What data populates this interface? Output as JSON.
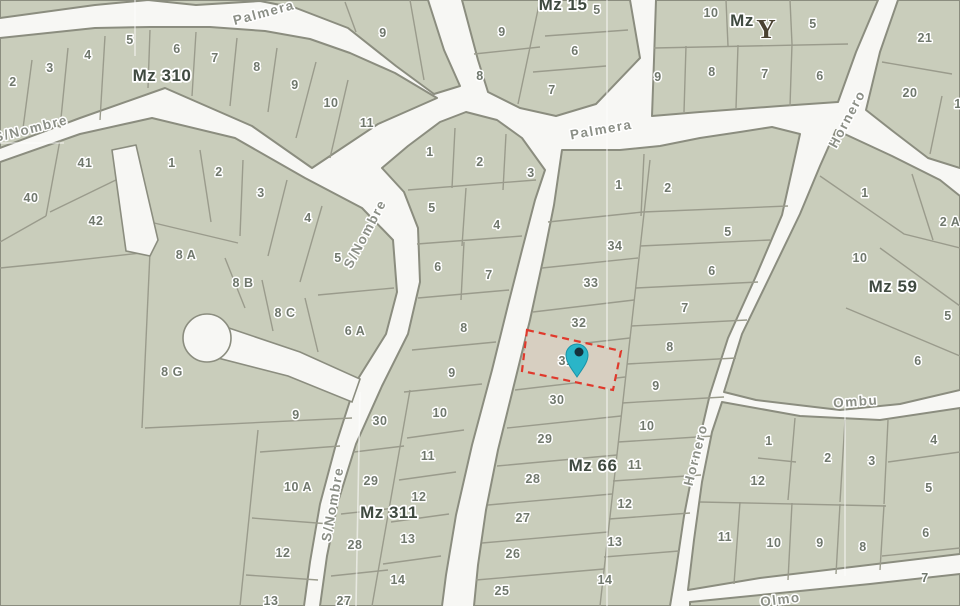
{
  "map": {
    "colors": {
      "street": "#f7f7f4",
      "parcel_fill": "#c9cdbb",
      "block_stroke": "#8b8d7f",
      "lot_line": "#9a9b8c",
      "faint_line": "rgba(255,255,255,0.55)",
      "parcel_label": "#6f776c",
      "block_label": "#3f4a40",
      "street_label": "#8b8f86",
      "highlight_fill": "#d7cfc1",
      "highlight_stroke": "#e0392c",
      "pin_fill": "#2ab5c8",
      "pin_stroke": "#1894a9",
      "pin_dot": "#15323d",
      "tree_icon": "#4a4232"
    },
    "street_labels": [
      {
        "text": "Palmera",
        "x": 265,
        "y": 17,
        "rot": -15
      },
      {
        "text": "Palmera",
        "x": 602,
        "y": 134,
        "rot": -10
      },
      {
        "text": "S/Nombre",
        "x": 32,
        "y": 133,
        "rot": -14
      },
      {
        "text": "S/Nombre",
        "x": 369,
        "y": 236,
        "rot": -62
      },
      {
        "text": "S/Nombre",
        "x": 337,
        "y": 505,
        "rot": -80
      },
      {
        "text": "Hornero",
        "x": 851,
        "y": 121,
        "rot": -62
      },
      {
        "text": "Hornero",
        "x": 700,
        "y": 456,
        "rot": -76
      },
      {
        "text": "Ombu",
        "x": 856,
        "y": 406,
        "rot": -4
      },
      {
        "text": "Olmo",
        "x": 781,
        "y": 604,
        "rot": -7
      }
    ],
    "blocks": [
      {
        "name": "mz310-band",
        "outline": "0,38 95,28 150,27 210,27 265,31 310,39 350,53 395,73 437,98 378,124 312,168 252,126 165,88 80,118 0,148",
        "label": {
          "text": "Mz 310",
          "x": 162,
          "y": 81
        },
        "parcels": [
          {
            "t": "2",
            "x": 13,
            "y": 86
          },
          {
            "t": "3",
            "x": 50,
            "y": 72
          },
          {
            "t": "4",
            "x": 88,
            "y": 59
          },
          {
            "t": "5",
            "x": 130,
            "y": 44
          },
          {
            "t": "6",
            "x": 177,
            "y": 53
          },
          {
            "t": "7",
            "x": 215,
            "y": 62
          },
          {
            "t": "8",
            "x": 257,
            "y": 71
          },
          {
            "t": "9",
            "x": 295,
            "y": 89
          },
          {
            "t": "10",
            "x": 331,
            "y": 107
          },
          {
            "t": "11",
            "x": 367,
            "y": 127
          }
        ],
        "lot_lines": [
          "32,60 22,136",
          "68,48 60,128",
          "105,36 100,120",
          "150,30 148,88",
          "196,32 192,96",
          "237,38 230,106",
          "277,48 268,112",
          "316,62 296,138",
          "348,80 330,158"
        ]
      },
      {
        "name": "corner-strip",
        "outline": "0,0 428,0 444,50 460,86 434,94 396,66 348,28 296,8 260,1 196,5 148,0 95,5 0,18",
        "parcels": [
          {
            "t": "9",
            "x": 383,
            "y": 37
          }
        ],
        "lot_lines": [
          "345,2 356,32",
          "410,0 424,80"
        ]
      },
      {
        "name": "mz15-block",
        "outline": "462,0 630,0 640,58 596,104 556,116 520,108 488,92 478,60",
        "label": {
          "text": "Mz 15",
          "x": 563,
          "y": 10
        },
        "parcels": [
          {
            "t": "9",
            "x": 502,
            "y": 36
          },
          {
            "t": "8",
            "x": 480,
            "y": 80
          },
          {
            "t": "5",
            "x": 597,
            "y": 14
          },
          {
            "t": "6",
            "x": 575,
            "y": 55
          },
          {
            "t": "7",
            "x": 552,
            "y": 94
          }
        ],
        "lot_lines": [
          "540,0 518,104",
          "545,36 628,30",
          "533,72 606,66",
          "474,54 540,47"
        ]
      },
      {
        "name": "mz-tree-block",
        "outline": "656,0 878,0 856,52 838,102 780,106 700,112 652,116 654,60",
        "label": {
          "text": "Mz",
          "x": 742,
          "y": 26
        },
        "parcels": [
          {
            "t": "10",
            "x": 711,
            "y": 17
          },
          {
            "t": "5",
            "x": 813,
            "y": 28
          },
          {
            "t": "9",
            "x": 658,
            "y": 81
          },
          {
            "t": "8",
            "x": 712,
            "y": 76
          },
          {
            "t": "7",
            "x": 765,
            "y": 78
          },
          {
            "t": "6",
            "x": 820,
            "y": 80
          }
        ],
        "lot_lines": [
          "654,48 848,44",
          "726,0 728,46",
          "790,0 792,44",
          "686,46 684,112",
          "738,45 736,108",
          "792,44 790,106"
        ]
      },
      {
        "name": "ne-block",
        "outline": "898,0 960,0 960,168 928,158 894,132 866,110 880,52",
        "parcels": [
          {
            "t": "21",
            "x": 925,
            "y": 42
          },
          {
            "t": "20",
            "x": 910,
            "y": 97
          },
          {
            "t": "1",
            "x": 958,
            "y": 108
          }
        ],
        "lot_lines": [
          "882,62 952,74",
          "942,96 930,154"
        ]
      },
      {
        "name": "mz59-block",
        "outline": "836,130 892,156 940,180 960,196 960,390 900,404 840,410 756,400 724,392 742,334 772,272 800,214 820,166",
        "label": {
          "text": "Mz 59",
          "x": 893,
          "y": 292
        },
        "parcels": [
          {
            "t": "1",
            "x": 865,
            "y": 197
          },
          {
            "t": "2 A",
            "x": 950,
            "y": 226
          },
          {
            "t": "10",
            "x": 860,
            "y": 262
          },
          {
            "t": "5",
            "x": 948,
            "y": 320
          },
          {
            "t": "6",
            "x": 918,
            "y": 365
          }
        ],
        "lot_lines": [
          "820,176 904,234 960,248",
          "912,174 933,240",
          "880,248 960,306",
          "846,308 960,356"
        ]
      },
      {
        "name": "mz66-block",
        "outline": "562,150 620,150 660,146 700,138 740,132 772,127 800,134 782,215 756,276 728,338 710,394 696,454 684,516 676,570 670,606 474,606 478,565 486,510 498,450 514,385 530,320 543,260 554,205",
        "label": {
          "text": "Mz 66",
          "x": 593,
          "y": 471
        },
        "parcels": [
          {
            "t": "1",
            "x": 619,
            "y": 189
          },
          {
            "t": "2",
            "x": 668,
            "y": 192
          },
          {
            "t": "34",
            "x": 615,
            "y": 250
          },
          {
            "t": "33",
            "x": 591,
            "y": 287
          },
          {
            "t": "32",
            "x": 579,
            "y": 327
          },
          {
            "t": "31",
            "x": 566,
            "y": 365
          },
          {
            "t": "30",
            "x": 557,
            "y": 404
          },
          {
            "t": "29",
            "x": 545,
            "y": 443
          },
          {
            "t": "28",
            "x": 533,
            "y": 483
          },
          {
            "t": "27",
            "x": 523,
            "y": 522
          },
          {
            "t": "26",
            "x": 513,
            "y": 558
          },
          {
            "t": "25",
            "x": 502,
            "y": 595
          },
          {
            "t": "5",
            "x": 728,
            "y": 236
          },
          {
            "t": "6",
            "x": 712,
            "y": 275
          },
          {
            "t": "7",
            "x": 685,
            "y": 312
          },
          {
            "t": "8",
            "x": 670,
            "y": 351
          },
          {
            "t": "9",
            "x": 656,
            "y": 390
          },
          {
            "t": "10",
            "x": 647,
            "y": 430
          },
          {
            "t": "11",
            "x": 635,
            "y": 469
          },
          {
            "t": "12",
            "x": 625,
            "y": 508
          },
          {
            "t": "13",
            "x": 615,
            "y": 546
          },
          {
            "t": "14",
            "x": 605,
            "y": 584
          }
        ],
        "lot_lines": [
          "650,160 600,606",
          "644,154 641,216",
          "548,222 643,212",
          "643,212 788,206",
          "542,268 638,258",
          "533,312 634,300",
          "524,350 630,338",
          "515,390 625,377",
          "507,428 621,416",
          "497,466 617,455",
          "488,505 612,494",
          "482,543 608,532",
          "476,580 604,569",
          "640,246 770,240",
          "636,288 758,282",
          "631,326 747,320",
          "627,364 736,358",
          "622,403 724,397",
          "618,442 713,436",
          "613,481 701,475",
          "609,519 690,513",
          "604,557 679,551"
        ]
      },
      {
        "name": "mz311-block",
        "outline": "404,192 382,168 408,146 440,122 466,112 497,120 522,138 545,170 535,200 522,250 508,305 492,370 472,445 456,515 446,575 442,606 320,606 327,556 338,502 356,444 382,386 408,334 420,282 418,228",
        "label": {
          "text": "Mz 311",
          "x": 389,
          "y": 518
        },
        "parcels": [
          {
            "t": "1",
            "x": 430,
            "y": 156
          },
          {
            "t": "2",
            "x": 480,
            "y": 166
          },
          {
            "t": "3",
            "x": 531,
            "y": 177
          },
          {
            "t": "5",
            "x": 432,
            "y": 212
          },
          {
            "t": "4",
            "x": 497,
            "y": 229
          },
          {
            "t": "6",
            "x": 438,
            "y": 271
          },
          {
            "t": "7",
            "x": 489,
            "y": 279
          },
          {
            "t": "8",
            "x": 464,
            "y": 332
          },
          {
            "t": "9",
            "x": 452,
            "y": 377
          },
          {
            "t": "10",
            "x": 440,
            "y": 417
          },
          {
            "t": "11",
            "x": 428,
            "y": 460
          },
          {
            "t": "12",
            "x": 419,
            "y": 501
          },
          {
            "t": "13",
            "x": 408,
            "y": 543
          },
          {
            "t": "14",
            "x": 398,
            "y": 584
          },
          {
            "t": "30",
            "x": 380,
            "y": 425
          },
          {
            "t": "29",
            "x": 371,
            "y": 485
          },
          {
            "t": "28",
            "x": 355,
            "y": 549
          },
          {
            "t": "27",
            "x": 344,
            "y": 605
          }
        ],
        "lot_lines": [
          "455,128 452,188",
          "506,134 503,190",
          "408,190 536,180",
          "466,188 462,246",
          "417,244 522,236",
          "464,242 461,300",
          "418,298 509,290",
          "412,350 496,342",
          "404,392 482,384",
          "410,390 372,606",
          "407,438 464,430",
          "399,480 456,472",
          "391,522 449,514",
          "383,564 441,556",
          "354,452 404,446",
          "341,514 396,508",
          "331,576 388,570"
        ]
      },
      {
        "name": "sw-superblock",
        "outline": "0,162 80,134 152,118 235,138 305,178 362,208 393,240 397,292 386,334 356,382 336,444 320,504 310,562 304,606 0,606",
        "parcels": [
          {
            "t": "41",
            "x": 85,
            "y": 167
          },
          {
            "t": "40",
            "x": 31,
            "y": 202
          },
          {
            "t": "42",
            "x": 96,
            "y": 225
          },
          {
            "t": "1",
            "x": 172,
            "y": 167
          },
          {
            "t": "2",
            "x": 219,
            "y": 176
          },
          {
            "t": "3",
            "x": 261,
            "y": 197
          },
          {
            "t": "4",
            "x": 308,
            "y": 222
          },
          {
            "t": "5",
            "x": 338,
            "y": 262
          },
          {
            "t": "8 A",
            "x": 186,
            "y": 259
          },
          {
            "t": "8 B",
            "x": 243,
            "y": 287
          },
          {
            "t": "8 C",
            "x": 285,
            "y": 317
          },
          {
            "t": "6 A",
            "x": 355,
            "y": 335
          },
          {
            "t": "8 G",
            "x": 172,
            "y": 376
          },
          {
            "t": "9",
            "x": 296,
            "y": 419
          },
          {
            "t": "10 A",
            "x": 298,
            "y": 491
          },
          {
            "t": "12",
            "x": 283,
            "y": 557
          },
          {
            "t": "13",
            "x": 271,
            "y": 605
          }
        ],
        "lot_lines": [
          "60,140 46,216",
          "120,178 50,212",
          "46,216 0,242",
          "150,252 60,262 0,268",
          "150,252 142,428",
          "200,150 211,222",
          "243,160 240,236",
          "287,180 268,256",
          "322,206 300,282",
          "150,222 238,243",
          "225,258 245,308",
          "262,280 273,331",
          "305,298 318,352",
          "318,295 394,288",
          "145,428 352,418",
          "258,430 240,606",
          "260,452 340,446",
          "252,518 330,524",
          "246,575 318,580"
        ]
      },
      {
        "name": "se-block",
        "outline": "722,402 800,416 880,420 960,408 960,554 860,566 760,578 688,590 694,540 702,482 712,432",
        "parcels": [
          {
            "t": "1",
            "x": 769,
            "y": 445
          },
          {
            "t": "2",
            "x": 828,
            "y": 462
          },
          {
            "t": "3",
            "x": 872,
            "y": 465
          },
          {
            "t": "4",
            "x": 934,
            "y": 444
          },
          {
            "t": "12",
            "x": 758,
            "y": 485
          },
          {
            "t": "5",
            "x": 929,
            "y": 492
          },
          {
            "t": "11",
            "x": 725,
            "y": 541
          },
          {
            "t": "10",
            "x": 774,
            "y": 547
          },
          {
            "t": "9",
            "x": 820,
            "y": 547
          },
          {
            "t": "8",
            "x": 863,
            "y": 551
          },
          {
            "t": "6",
            "x": 926,
            "y": 537
          },
          {
            "t": "7",
            "x": 925,
            "y": 582
          }
        ],
        "lot_lines": [
          "795,418 788,500",
          "845,420 840,502",
          "888,420 884,504",
          "888,462 960,452",
          "758,458 796,462",
          "700,502 886,506",
          "740,502 734,584",
          "792,503 788,580",
          "840,504 836,574",
          "884,505 880,570",
          "882,556 960,548"
        ]
      },
      {
        "name": "bottom-sliver",
        "outline": "690,602 770,594 870,584 960,574 960,606 690,606",
        "parcels": [],
        "lot_lines": []
      }
    ],
    "overlays": {
      "stub_street": "112,150 136,145 158,240 150,256 126,251",
      "culdesac": {
        "cx": 207,
        "cy": 338,
        "r": 24,
        "corridor": "220,325 300,352 360,379 352,402 288,376 214,357"
      }
    },
    "faint_lines": [
      "607,0 607,606",
      "135,0 135,56",
      "845,402 845,576",
      "360,392 356,606",
      "0,143 64,143"
    ],
    "highlight": {
      "parcel": "31",
      "points": "527,330 621,351 613,390 522,371"
    },
    "pin": {
      "cx": 577,
      "cy": 355,
      "r": 11,
      "tip_y": 377,
      "dot_cx": 579,
      "dot_cy": 352,
      "dot_r": 4.5
    },
    "tree_icon": {
      "glyph": "Y",
      "x": 766,
      "y": 38
    }
  }
}
